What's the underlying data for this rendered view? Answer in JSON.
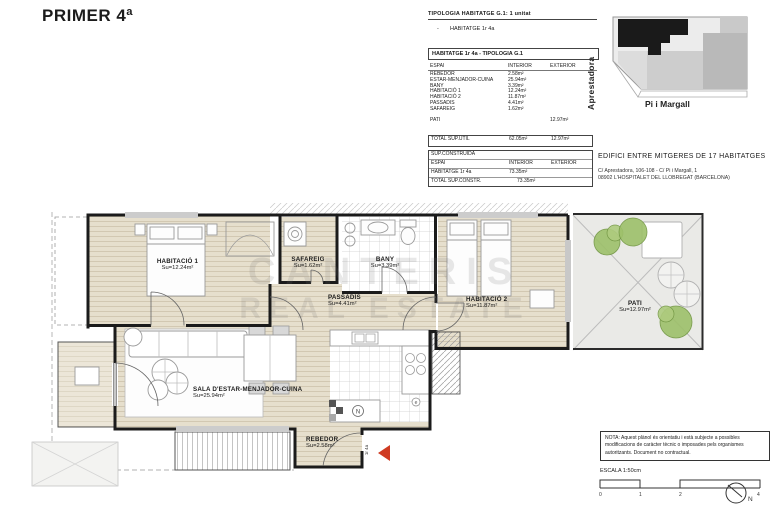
{
  "title": "PRIMER 4ª",
  "typology": {
    "header": "TIPOLOGIA HABITATGE G.1: 1 unitat",
    "bullet": "-",
    "item": "HABITATGE 1r 4a"
  },
  "area_table": {
    "header": "HABITATGE 1r 4a - TIPOLOGIA G.1",
    "columns": {
      "espai": "ESPAI",
      "interior": "INTERIOR",
      "exterior": "EXTERIOR"
    },
    "rows": [
      {
        "espai": "REBEDOR",
        "interior": "2.58m²"
      },
      {
        "espai": "ESTAR-MENJADOR-CUINA",
        "interior": "25.94m²"
      },
      {
        "espai": "BANY",
        "interior": "3.39m²"
      },
      {
        "espai": "HABITACIÓ 1",
        "interior": "12.24m²"
      },
      {
        "espai": "HABITACIÓ 2",
        "interior": "11.87m²"
      },
      {
        "espai": "PASSADIS",
        "interior": "4.41m²"
      },
      {
        "espai": "SAFAREIG",
        "interior": "1.62m²"
      }
    ],
    "pati": {
      "espai": "PATI",
      "exterior": "12.97m²"
    },
    "total": {
      "label": "TOTAL SUP.UTIL",
      "interior": "62.05m²",
      "exterior": "12.97m²"
    }
  },
  "constructed_table": {
    "header": "SUP.CONSTRUIDA",
    "columns": {
      "espai": "ESPAI",
      "interior": "INTERIOR",
      "exterior": "EXTERIOR"
    },
    "row": {
      "espai": "HABITATGE 1r 4a",
      "interior": "73.35m²"
    },
    "total": {
      "label": "TOTAL SUP.CONSTR.",
      "value": "73.35m²"
    }
  },
  "location_map": {
    "street_left": "Aprestadora",
    "street_bottom": "Pi i Margall"
  },
  "building": {
    "title": "EDIFICI ENTRE MITGERES DE 17 HABITATGES",
    "address1": "C/ Aprestadora, 106-108 - C/ Pi i Margall, 1",
    "address2": "08902 L'HOSPITALET DEL LLOBREGAT (BARCELONA)"
  },
  "plan": {
    "rooms": {
      "hab1": {
        "name": "HABITACIÓ 1",
        "su": "Su=12.24m²"
      },
      "safareig": {
        "name": "SAFAREIG",
        "su": "Su=1.62m²"
      },
      "bany": {
        "name": "BANY",
        "su": "Su=3.39m²"
      },
      "passadis": {
        "name": "PASSADÍS",
        "su": "Su=4.41m²"
      },
      "hab2": {
        "name": "HABITACIÓ 2",
        "su": "Su=11.87m²"
      },
      "pati": {
        "name": "PATI",
        "su": "Su=12.97m²"
      },
      "sala": {
        "name": "SALA D'ESTAR-MENJADOR-CUINA",
        "su": "Su=25.94m²"
      },
      "rebedor": {
        "name": "REBEDOR",
        "su": "Su=2.58m²"
      }
    },
    "door_label": "1r 4a",
    "kitchen_symbol_n": "N",
    "kitchen_symbol_e": "e",
    "watermark_line1": "CANTERIS",
    "watermark_line2": "REAL ESTATE"
  },
  "note": {
    "line1": "NOTA: Aquest plànol és orientatiu i està subjecte a possibles",
    "line2": "modificacions de caràcter tècnic o imposades pels organismes",
    "line3": "autoritzants. Document no contractual."
  },
  "scale": {
    "label": "ESCALA 1:50cm",
    "ticks": [
      "0",
      "1",
      "2",
      "4"
    ]
  },
  "compass": {
    "north": "N"
  },
  "colors": {
    "wood_floor": "#e6dfcd",
    "pati_gray": "#eaeae7",
    "wall": "#1b1b1b",
    "arrow_red": "#cf3b22",
    "bush_green": "#9dc06a",
    "map_building_black": "#1a1a1a"
  }
}
